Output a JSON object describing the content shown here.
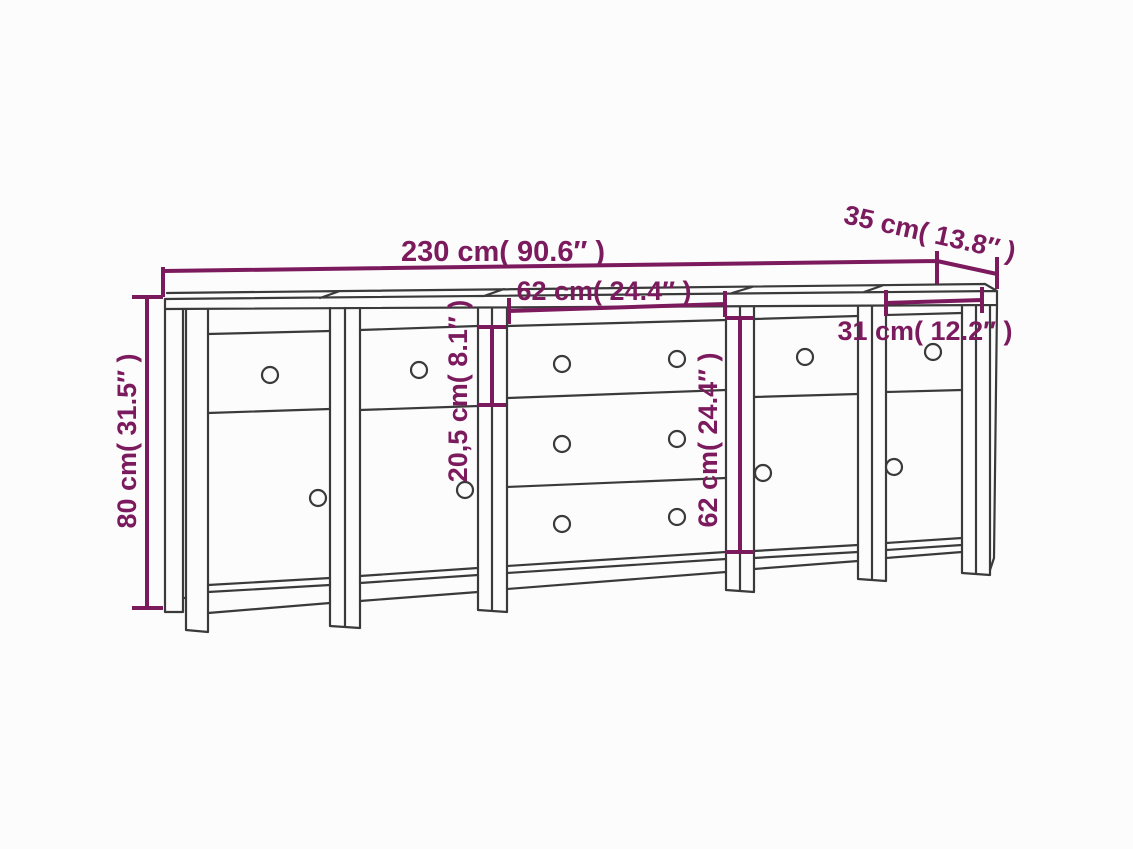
{
  "diagram": {
    "kind": "furniture dimension line drawing",
    "subject": "sideboard with five sections, drawers and doors",
    "colors": {
      "accent": "#7c1a5e",
      "line": "#3a3a3a",
      "bg": "#fcfcfc"
    },
    "labels": {
      "total_width": "230 cm( 90.6″ )",
      "depth": "35 cm( 13.8″ )",
      "total_height": "80 cm( 31.5″ )",
      "center_section_width": "62 cm( 24.4″ )",
      "drawer_height": "20,5 cm( 8.1″ )",
      "drawer_stack_height": "62 cm( 24.4″ )",
      "side_cabinet_width": "31 cm( 12.2″ )"
    }
  }
}
